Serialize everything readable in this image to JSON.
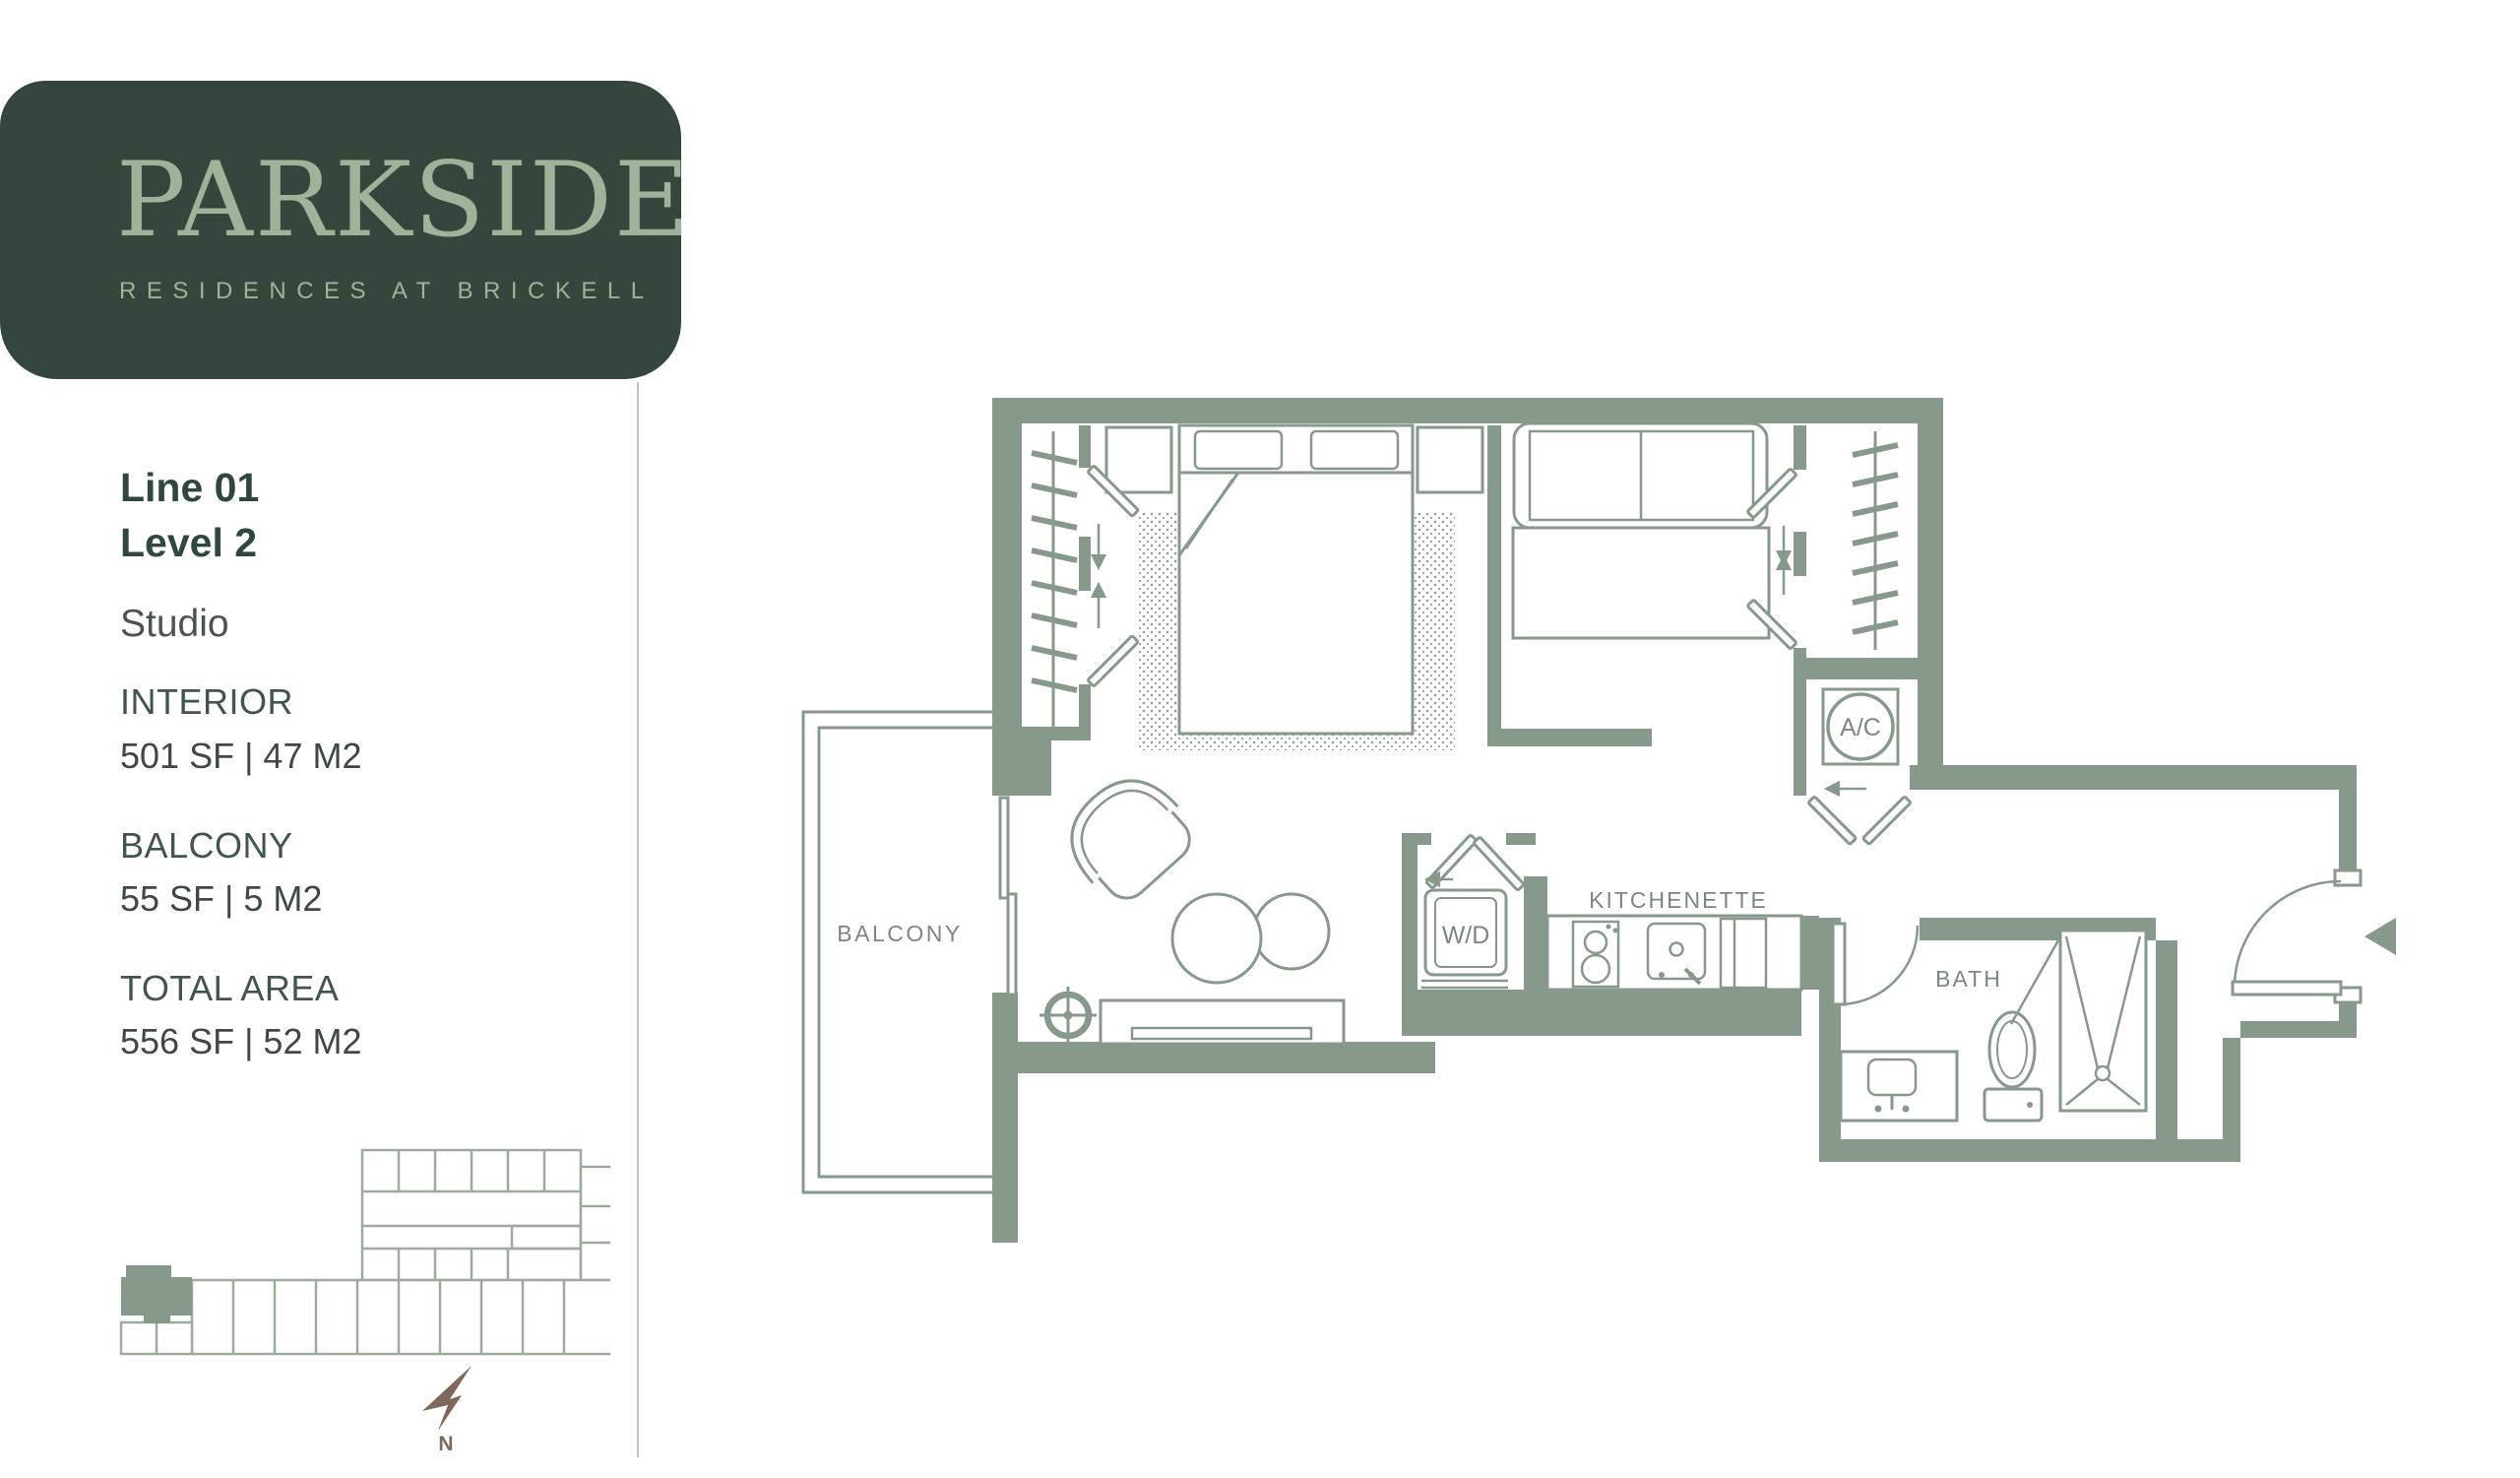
{
  "brand": {
    "name": "PARKSIDE",
    "tagline": "RESIDENCES AT BRICKELL"
  },
  "unit": {
    "line": "Line 01",
    "level": "Level 2",
    "type": "Studio"
  },
  "areas": [
    {
      "label": "INTERIOR",
      "value": "501 SF | 47 M2"
    },
    {
      "label": "BALCONY",
      "value": "55 SF | 5 M2"
    },
    {
      "label": "TOTAL AREA",
      "value": "556 SF | 52 M2"
    }
  ],
  "floor_plan": {
    "labels": {
      "balcony": "BALCONY",
      "kitchenette": "KITCHENETTE",
      "bath": "BATH",
      "washer_dryer": "W/D",
      "ac": "A/C"
    }
  },
  "key_plan": {
    "compass_label": "N"
  },
  "colors": {
    "wall": "#87998a",
    "panel": "#35473d",
    "logo_text": "#9eb399",
    "plan_label": "#7a897e",
    "key_outline": "#9cab9c",
    "compass": "#7d685a",
    "heading": "#2f473c",
    "body_text": "#3f4944"
  }
}
